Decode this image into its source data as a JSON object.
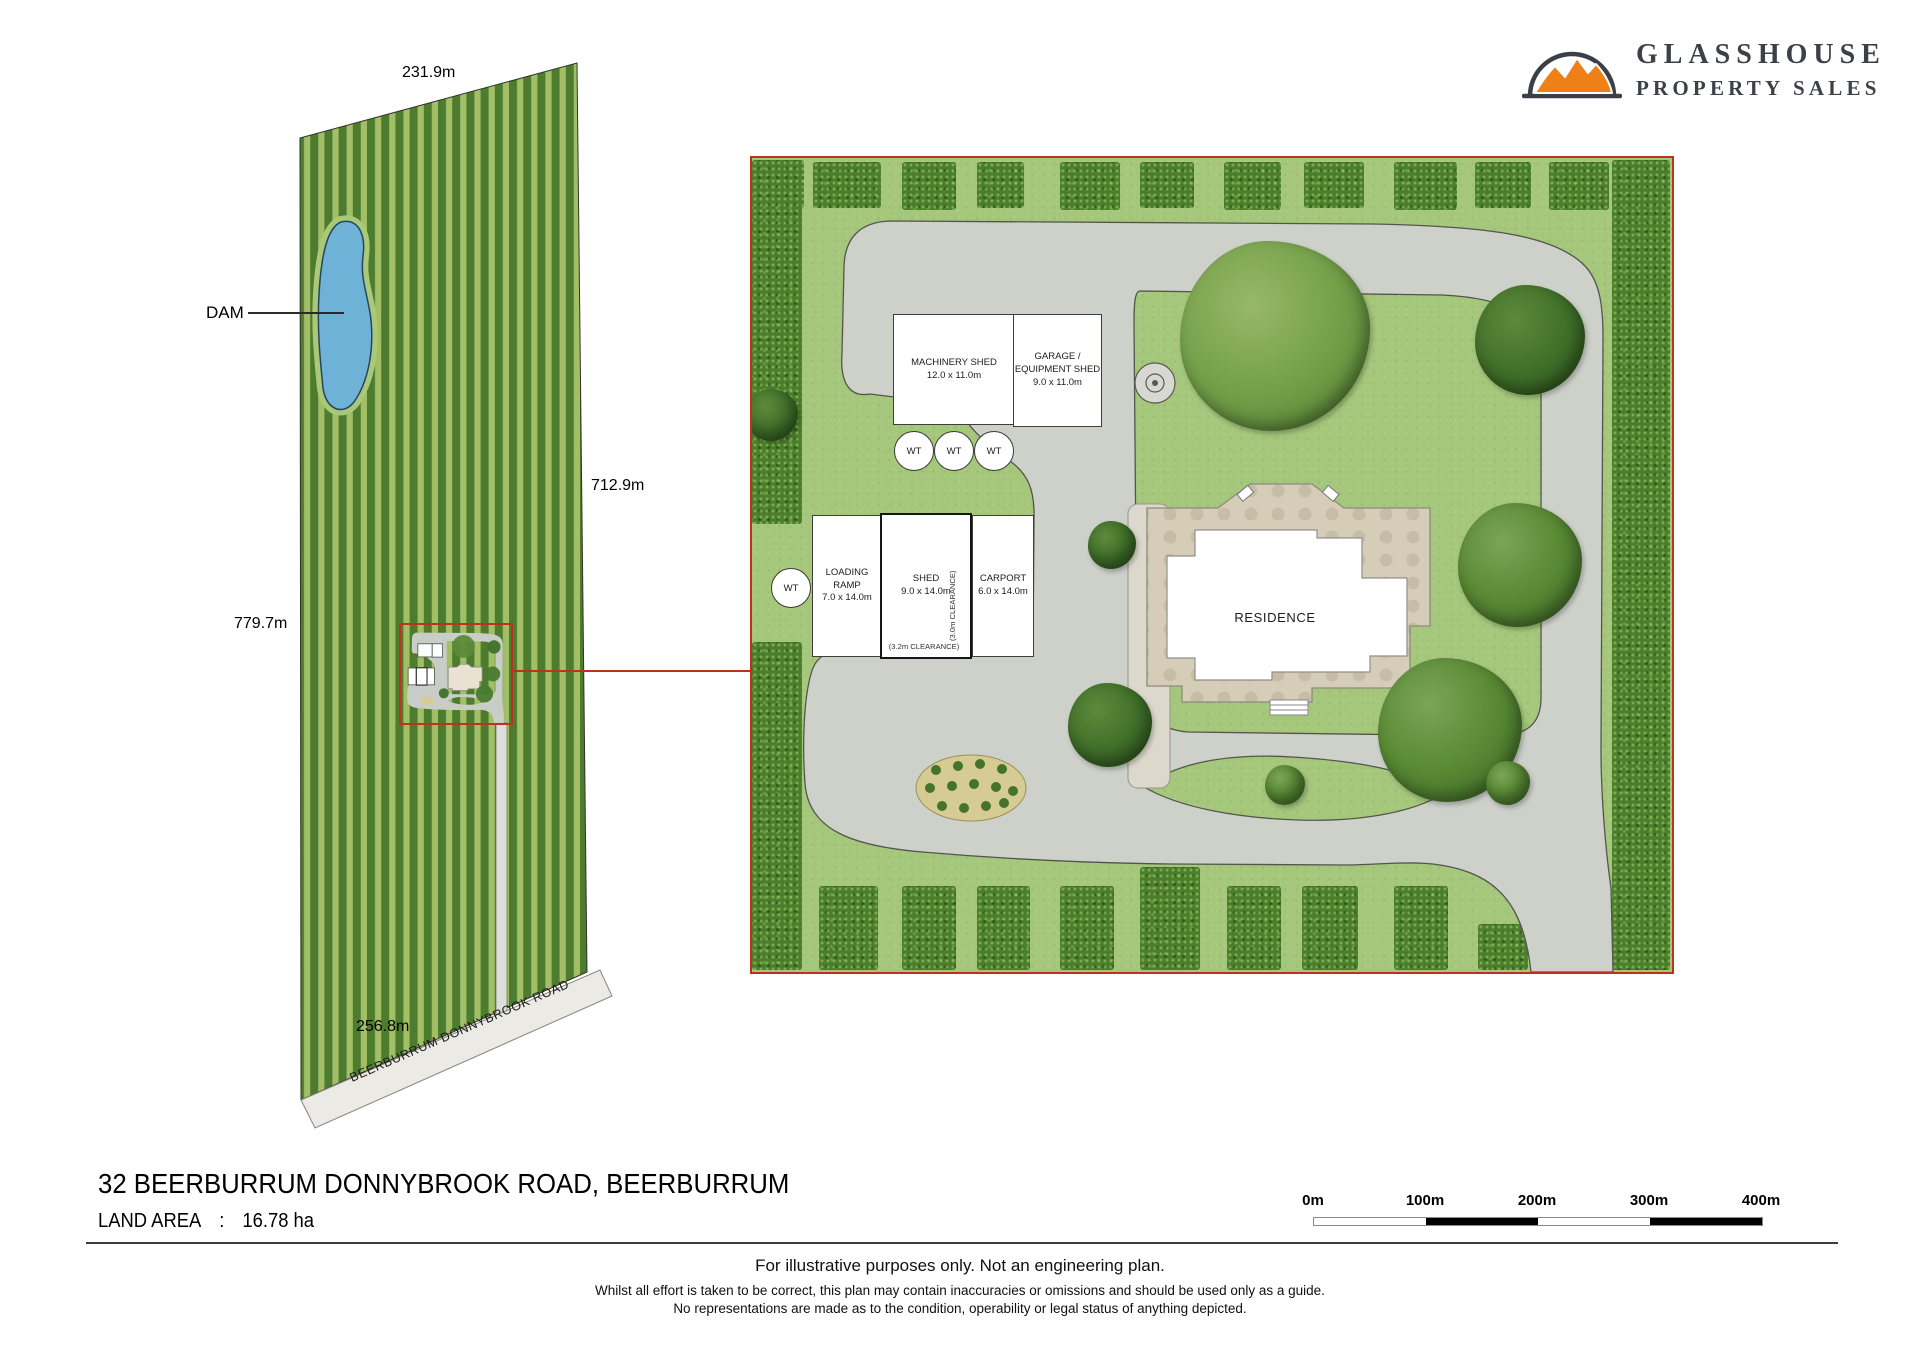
{
  "branding": {
    "name_line1": "GLASSHOUSE",
    "name_line2": "PROPERTY SALES"
  },
  "overview": {
    "dim_top": "231.9m",
    "dim_right": "712.9m",
    "dim_left": "779.7m",
    "dim_bottom": "256.8m",
    "dam_label": "DAM",
    "road_label": "BEERBURRUM DONNYBROOK ROAD"
  },
  "detail": {
    "machinery_shed": {
      "name": "MACHINERY SHED",
      "size": "12.0 x 11.0m"
    },
    "garage": {
      "name_line1": "GARAGE /",
      "name_line2": "EQUIPMENT SHED",
      "size": "9.0 x 11.0m"
    },
    "loading_ramp": {
      "name": "LOADING RAMP",
      "size": "7.0 x 14.0m"
    },
    "shed": {
      "name": "SHED",
      "size": "9.0 x 14.0m",
      "clearance_side": "(3.0m CLEARANCE)",
      "clearance_bottom": "(3.2m CLEARANCE)"
    },
    "carport": {
      "name": "CARPORT",
      "size": "6.0 x 14.0m"
    },
    "residence_label": "RESIDENCE",
    "water_tank_label": "WT"
  },
  "footer": {
    "address": "32 BEERBURRUM DONNYBROOK ROAD, BEERBURRUM",
    "land_area_label": "LAND AREA",
    "land_area_sep": ":",
    "land_area_value": "16.78 ha",
    "scale": {
      "labels": [
        "0m",
        "100m",
        "200m",
        "300m",
        "400m"
      ]
    },
    "disclaimer1": "For illustrative purposes only. Not an engineering plan.",
    "disclaimer2": "Whilst all effort is taken to be correct, this plan may contain inaccuracies or omissions and should be used only as a guide.",
    "disclaimer3": "No representations are made as to the condition, operability or legal status of anything depicted."
  },
  "colors": {
    "accent_red": "#c0301f",
    "dam_blue": "#6fb2d8",
    "logo_orange": "#ef7f17",
    "grass_green": "#a5c77b",
    "hedge_green": "#4a7e2c",
    "driveway_grey": "#cdd1ca"
  }
}
